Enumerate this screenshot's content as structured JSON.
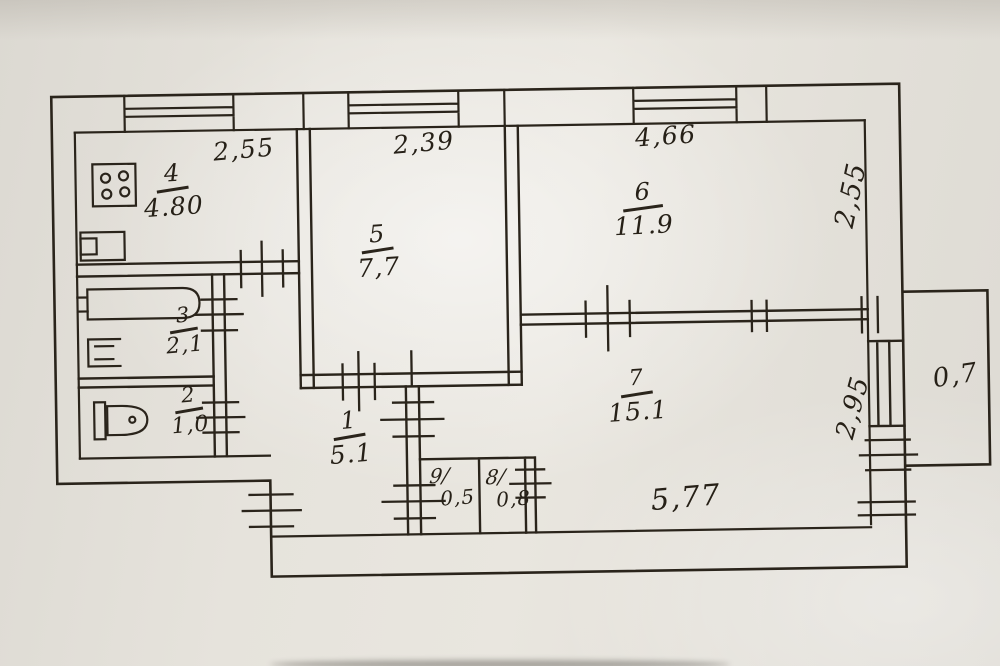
{
  "plan": {
    "title": "apartment-floor-plan-scan",
    "rooms": [
      {
        "key": "kitchen",
        "number": "4",
        "area": "4.80"
      },
      {
        "key": "room5",
        "number": "5",
        "area": "7,7"
      },
      {
        "key": "room6",
        "number": "6",
        "area": "11.9"
      },
      {
        "key": "bathroom",
        "number": "3",
        "area": "2,1"
      },
      {
        "key": "toilet",
        "number": "2",
        "area": "1,0"
      },
      {
        "key": "hall",
        "number": "1",
        "area": "5.1"
      },
      {
        "key": "room7",
        "number": "7",
        "area": "15.1"
      },
      {
        "key": "closet9",
        "number": "9/",
        "area": "0,5"
      },
      {
        "key": "closet8",
        "number": "8/",
        "area": "0,8"
      }
    ],
    "balcony_area": "0,7",
    "dimensions": {
      "top": [
        "2,55",
        "2,39",
        "4,66"
      ],
      "right_upper": "2,55",
      "right_lower": "2,95",
      "bottom": "5,77"
    },
    "colors": {
      "paper": "#e4e1da",
      "ink": "#2a241b"
    }
  }
}
